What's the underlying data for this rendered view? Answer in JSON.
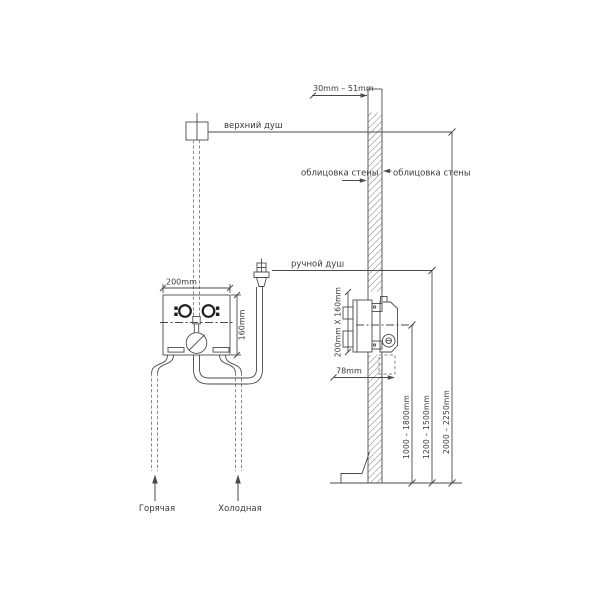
{
  "drawing": {
    "labels": {
      "top_shower": "верхний душ",
      "hand_shower": "ручной душ",
      "wall_cladding_left": "облицовка стены",
      "wall_cladding_right": "облицовка стены",
      "hot_supply": "Горячая",
      "cold_supply": "Холодная"
    },
    "dimensions": {
      "wall_thickness": "30mm – 51mm",
      "box_width": "200mm",
      "box_height": "160mm",
      "body_size": "200mm X 160mm",
      "body_depth": "78mm",
      "mixer_height": "1000 – 1800mm",
      "hand_shower_height": "1200 – 1500mm",
      "top_shower_height": "2000 – 2250mm"
    },
    "colors": {
      "line": "#4a4a4a",
      "dashed_pipe": "#8a8a8a",
      "text": "#3a3a3a",
      "background": "#ffffff"
    }
  }
}
